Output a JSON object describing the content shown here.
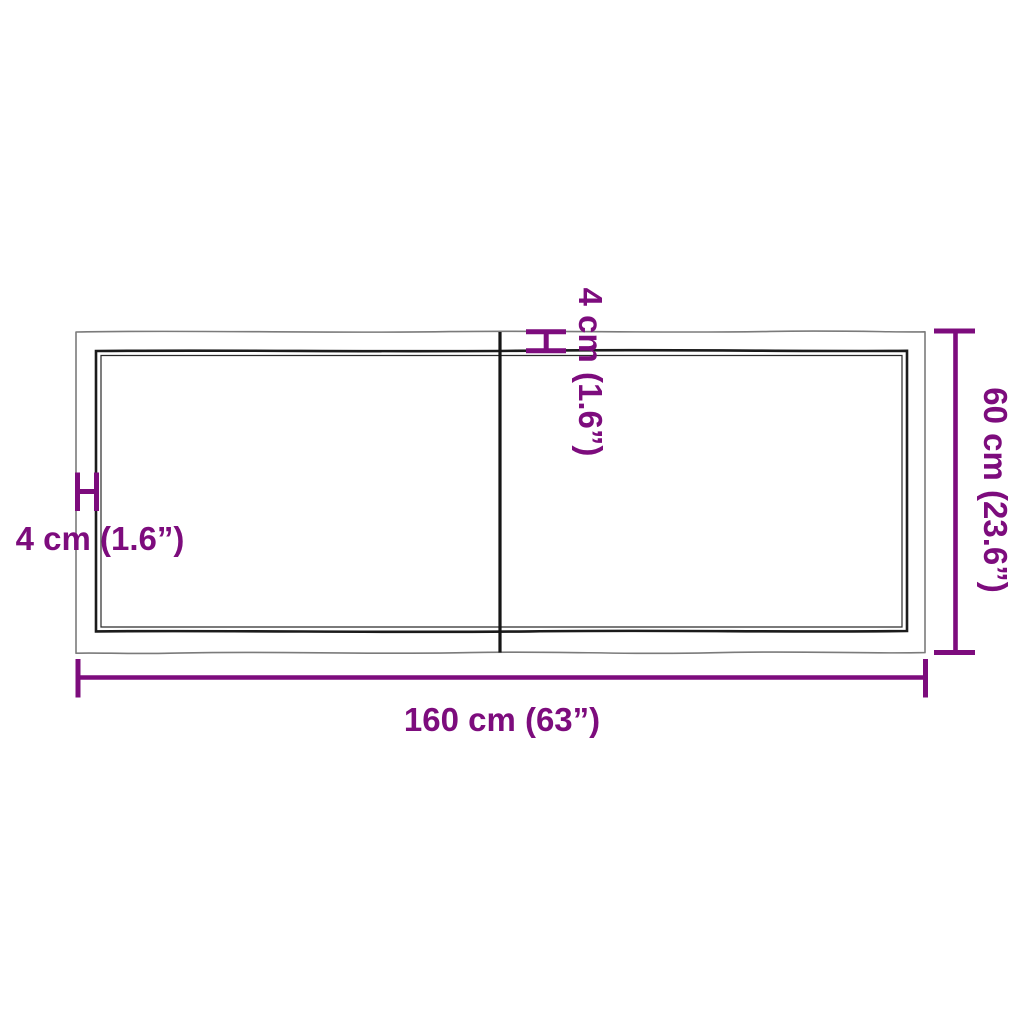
{
  "diagram": {
    "type": "product-dimension-diagram",
    "subject": "two-piece live-edge table top, top view with thickness markers",
    "colors": {
      "accent_purple": "#7d0c7d",
      "outer_outline_gray": "#7b7b7b",
      "inner_outline_dark": "#1b1b1b",
      "background": "#ffffff"
    },
    "labels": {
      "width": "160 cm (63”)",
      "depth": "60 cm (23.6”)",
      "thickness_side": "4 cm (1.6”)",
      "thickness_top": "4 cm (1.6”)"
    }
  }
}
